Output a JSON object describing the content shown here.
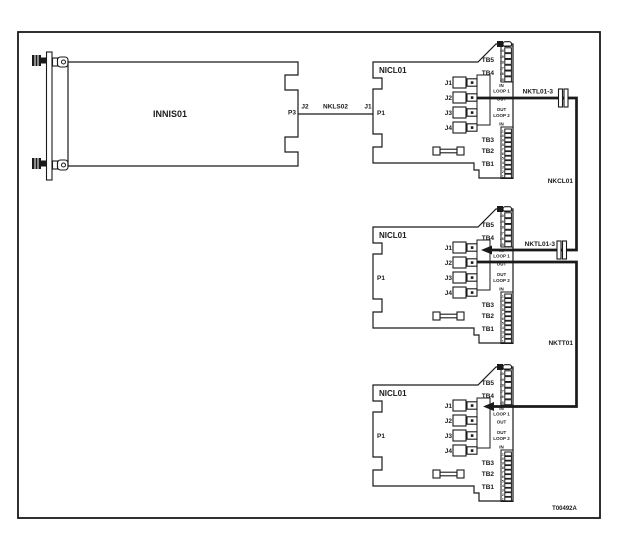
{
  "diagram": {
    "figure_id": "T00492A",
    "colors": {
      "ink": "#1a1a1a",
      "paper": "#ffffff"
    },
    "innis_card": {
      "name": "INNIS01",
      "port": "P3"
    },
    "nkls02_link": {
      "from_port": "J2",
      "cable": "NKLS02",
      "to_port": "J1"
    },
    "nicl01_card": {
      "name": "NICL01",
      "backplane_port": "P1",
      "jacks": [
        "J1",
        "J2",
        "J3",
        "J4"
      ],
      "loop_labels": [
        "IN",
        "LOOP 1",
        "OUT",
        "OUT",
        "LOOP 2",
        "IN"
      ],
      "terminal_blocks_top": [
        "TB5",
        "TB4"
      ],
      "terminal_blocks_bottom": [
        "TB3",
        "TB2",
        "TB1"
      ],
      "top_strip_pins": [
        "30",
        "29",
        "28",
        "27",
        "26",
        "25"
      ],
      "bottom_strip_pins": [
        "11",
        "10",
        "9",
        "8",
        "7",
        "6",
        "5",
        "4",
        "3",
        "2",
        "1"
      ]
    },
    "cable_runs": [
      {
        "label": "NKTL01-3"
      },
      {
        "label": "NKCL01"
      },
      {
        "label": "NKTL01-3"
      },
      {
        "label": "NKTT01"
      }
    ]
  }
}
